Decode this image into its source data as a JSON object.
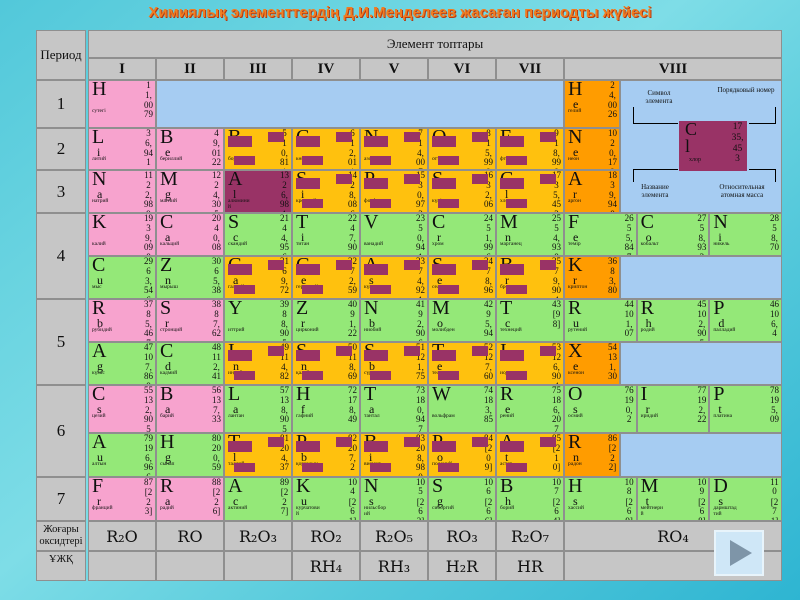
{
  "title": "Химиялық элементтердің Д.И.Менделеев жасаған периодты жүйесі",
  "colors": {
    "title": "#f07d22",
    "gray": "#c6c6c6",
    "pink": "#f7a3ce",
    "green": "#94e878",
    "gold": "#ffc10e",
    "orange": "#ff9c00",
    "plum": "#993366",
    "blue": "#a6ccf2"
  },
  "header": {
    "period_label": "Период",
    "groups_label": "Элемент топтары",
    "groups": [
      "I",
      "II",
      "III",
      "IV",
      "V",
      "VI",
      "VII",
      "VIII"
    ]
  },
  "side": {
    "periods": [
      "1",
      "2",
      "3",
      "4",
      "5",
      "6",
      "7"
    ],
    "oxides_label": "Жоғары оксидтері",
    "volatile_label": "ҰЖҚ"
  },
  "legend": {
    "symbol_label": "Символ элемента",
    "number_label": "Порядковый номер",
    "name_label": "Название элемента",
    "mass_label": "Относительная атомная масса",
    "example": {
      "sym": "Cl",
      "num": "17",
      "mass": "35,453",
      "name": "хлор"
    }
  },
  "bottom": {
    "oxides": [
      "R₂O",
      "RO",
      "R₂O₃",
      "RO₂",
      "R₂O₅",
      "RO₃",
      "R₂O₇",
      "RO₄"
    ],
    "hydrides": [
      "",
      "",
      "",
      "RH₄",
      "RH₃",
      "H₂R",
      "HR",
      ""
    ]
  },
  "nav": {
    "play_icon": "play-triangle"
  },
  "rows": [
    {
      "id": "p1",
      "cells": [
        {
          "w": "g",
          "t": "pink",
          "sym": "H",
          "num": "1",
          "mass": "1,0079",
          "name": "сутегі"
        },
        {
          "w": "g6",
          "t": "blue"
        },
        {
          "w": "noble",
          "t": "orange",
          "sym": "He",
          "num": "2",
          "mass": "4,0026",
          "name": "гелий"
        }
      ]
    },
    {
      "id": "p2",
      "cells": [
        {
          "w": "g",
          "t": "pink",
          "sym": "Li",
          "num": "3",
          "mass": "6,941",
          "name": "литий"
        },
        {
          "w": "g",
          "t": "pink",
          "sym": "Be",
          "num": "4",
          "mass": "9,0122",
          "name": "бериллий"
        },
        {
          "w": "g",
          "t": "gold",
          "sym": "B",
          "num": "5",
          "mass": "10,811",
          "name": "бор"
        },
        {
          "w": "g",
          "t": "gold",
          "sym": "C",
          "num": "6",
          "mass": "12,011",
          "name": "көміртек"
        },
        {
          "w": "g",
          "t": "gold",
          "sym": "N",
          "num": "7",
          "mass": "14,007",
          "name": "азот"
        },
        {
          "w": "g",
          "t": "gold",
          "sym": "O",
          "num": "8",
          "mass": "15,999",
          "name": "оттек"
        },
        {
          "w": "g",
          "t": "gold",
          "sym": "F",
          "num": "9",
          "mass": "18,998",
          "name": "фтор"
        },
        {
          "w": "noble",
          "t": "orange",
          "sym": "Ne",
          "num": "10",
          "mass": "20,179",
          "name": "неон"
        }
      ]
    },
    {
      "id": "p3",
      "cells": [
        {
          "w": "g",
          "t": "pink",
          "sym": "Na",
          "num": "11",
          "mass": "22,989",
          "name": "натрий"
        },
        {
          "w": "g",
          "t": "pink",
          "sym": "Mg",
          "num": "12",
          "mass": "24,305",
          "name": "магний"
        },
        {
          "w": "g",
          "t": "plum",
          "sym": "Al",
          "num": "13",
          "mass": "26,981",
          "name": "алюминий"
        },
        {
          "w": "g",
          "t": "gold",
          "sym": "Si",
          "num": "14",
          "mass": "28,086",
          "name": "кремний"
        },
        {
          "w": "g",
          "t": "gold",
          "sym": "P",
          "num": "15",
          "mass": "30,973",
          "name": "фосфор"
        },
        {
          "w": "g",
          "t": "gold",
          "sym": "S",
          "num": "16",
          "mass": "32,06",
          "name": "күкірт"
        },
        {
          "w": "g",
          "t": "gold",
          "sym": "Cl",
          "num": "17",
          "mass": "35,453",
          "name": "хлор"
        },
        {
          "w": "noble",
          "t": "orange",
          "sym": "Ar",
          "num": "18",
          "mass": "39,948",
          "name": "аргон"
        }
      ]
    },
    {
      "id": "p4a",
      "cells": [
        {
          "w": "g",
          "t": "pink",
          "sym": "K",
          "num": "19",
          "mass": "39,098",
          "name": "калий"
        },
        {
          "w": "g",
          "t": "pink",
          "sym": "Ca",
          "num": "20",
          "mass": "40,08",
          "name": "кальций"
        },
        {
          "w": "g",
          "t": "green",
          "sym": "Sc",
          "num": "21",
          "mass": "44,956",
          "name": "скандий"
        },
        {
          "w": "g",
          "t": "green",
          "sym": "Ti",
          "num": "22",
          "mass": "47,90",
          "name": "титан"
        },
        {
          "w": "g",
          "t": "green",
          "sym": "V",
          "num": "23",
          "mass": "50,941",
          "name": "ванадий"
        },
        {
          "w": "g",
          "t": "green",
          "sym": "Cr",
          "num": "24",
          "mass": "51,996",
          "name": "хром"
        },
        {
          "w": "g",
          "t": "green",
          "sym": "Mn",
          "num": "25",
          "mass": "54,938",
          "name": "марганец"
        },
        {
          "w": "t",
          "t": "green",
          "sym": "Fe",
          "num": "26",
          "mass": "55,847",
          "name": "темір"
        },
        {
          "w": "t",
          "t": "green",
          "sym": "Co",
          "num": "27",
          "mass": "58,933",
          "name": "кобальт"
        },
        {
          "w": "t",
          "t": "green",
          "sym": "Ni",
          "num": "28",
          "mass": "58,70",
          "name": "никель"
        }
      ]
    },
    {
      "id": "p4b",
      "cells": [
        {
          "w": "g",
          "t": "green",
          "sym": "Cu",
          "num": "29",
          "mass": "63,546",
          "name": "мыс"
        },
        {
          "w": "g",
          "t": "green",
          "sym": "Zn",
          "num": "30",
          "mass": "65,38",
          "name": "мырыш"
        },
        {
          "w": "g",
          "t": "gold",
          "sym": "Ga",
          "num": "31",
          "mass": "69,72",
          "name": "галлий"
        },
        {
          "w": "g",
          "t": "gold",
          "sym": "Ge",
          "num": "32",
          "mass": "72,59",
          "name": "германий"
        },
        {
          "w": "g",
          "t": "gold",
          "sym": "As",
          "num": "33",
          "mass": "74,921",
          "name": "күшән"
        },
        {
          "w": "g",
          "t": "gold",
          "sym": "Se",
          "num": "34",
          "mass": "78,96",
          "name": "селен"
        },
        {
          "w": "g",
          "t": "gold",
          "sym": "Br",
          "num": "35",
          "mass": "79,904",
          "name": "бром"
        },
        {
          "w": "noble",
          "t": "orange",
          "sym": "Kr",
          "num": "36",
          "mass": "83,80",
          "name": "криптон"
        },
        {
          "w": "nr",
          "t": "blue"
        }
      ]
    },
    {
      "id": "p5a",
      "cells": [
        {
          "w": "g",
          "t": "pink",
          "sym": "Rb",
          "num": "37",
          "mass": "85,467",
          "name": "рубидий"
        },
        {
          "w": "g",
          "t": "pink",
          "sym": "Sr",
          "num": "38",
          "mass": "87,62",
          "name": "стронций"
        },
        {
          "w": "g",
          "t": "green",
          "sym": "Y",
          "num": "39",
          "mass": "88,905",
          "name": "иттрий"
        },
        {
          "w": "g",
          "t": "green",
          "sym": "Zr",
          "num": "40",
          "mass": "91,22",
          "name": "цирконий"
        },
        {
          "w": "g",
          "t": "green",
          "sym": "Nb",
          "num": "41",
          "mass": "92,906",
          "name": "ниобий"
        },
        {
          "w": "g",
          "t": "green",
          "sym": "Mo",
          "num": "42",
          "mass": "95,94",
          "name": "молибден"
        },
        {
          "w": "g",
          "t": "green",
          "sym": "Tc",
          "num": "43",
          "mass": "[98]",
          "name": "технеций"
        },
        {
          "w": "t",
          "t": "green",
          "sym": "Ru",
          "num": "44",
          "mass": "101,07",
          "name": "рутений"
        },
        {
          "w": "t",
          "t": "green",
          "sym": "Rh",
          "num": "45",
          "mass": "102,905",
          "name": "родий"
        },
        {
          "w": "t",
          "t": "green",
          "sym": "Pd",
          "num": "46",
          "mass": "106,4",
          "name": "палладий"
        }
      ]
    },
    {
      "id": "p5b",
      "cells": [
        {
          "w": "g",
          "t": "green",
          "sym": "Ag",
          "num": "47",
          "mass": "107,868",
          "name": "күміс"
        },
        {
          "w": "g",
          "t": "green",
          "sym": "Cd",
          "num": "48",
          "mass": "112,41",
          "name": "кадмий"
        },
        {
          "w": "g",
          "t": "gold",
          "sym": "In",
          "num": "49",
          "mass": "114,82",
          "name": "индий"
        },
        {
          "w": "g",
          "t": "gold",
          "sym": "Sn",
          "num": "50",
          "mass": "118,69",
          "name": "қалайы"
        },
        {
          "w": "g",
          "t": "gold",
          "sym": "Sb",
          "num": "51",
          "mass": "121,75",
          "name": "сүрме"
        },
        {
          "w": "g",
          "t": "gold",
          "sym": "Te",
          "num": "52",
          "mass": "127,60",
          "name": "теллур"
        },
        {
          "w": "g",
          "t": "gold",
          "sym": "I",
          "num": "53",
          "mass": "126,904",
          "name": "иод"
        },
        {
          "w": "noble",
          "t": "orange",
          "sym": "Xe",
          "num": "54",
          "mass": "131,30",
          "name": "ксенон"
        },
        {
          "w": "nr",
          "t": "blue"
        }
      ]
    },
    {
      "id": "p6a",
      "cells": [
        {
          "w": "g",
          "t": "pink",
          "sym": "Cs",
          "num": "55",
          "mass": "132,905",
          "name": "цезий"
        },
        {
          "w": "g",
          "t": "pink",
          "sym": "Ba",
          "num": "56",
          "mass": "137,33",
          "name": "барий"
        },
        {
          "w": "g",
          "t": "green",
          "sym": "La",
          "num": "57",
          "mass": "138,905",
          "name": "лантан"
        },
        {
          "w": "g",
          "t": "green",
          "sym": "Hf",
          "num": "72",
          "mass": "178,49",
          "name": "гафний"
        },
        {
          "w": "g",
          "t": "green",
          "sym": "Ta",
          "num": "73",
          "mass": "180,947",
          "name": "тантал"
        },
        {
          "w": "g",
          "t": "green",
          "sym": "W",
          "num": "74",
          "mass": "183,85",
          "name": "вольфрам"
        },
        {
          "w": "g",
          "t": "green",
          "sym": "Re",
          "num": "75",
          "mass": "186,207",
          "name": "рений"
        },
        {
          "w": "t",
          "t": "green",
          "sym": "Os",
          "num": "76",
          "mass": "190,2",
          "name": "осмий"
        },
        {
          "w": "t",
          "t": "green",
          "sym": "Ir",
          "num": "77",
          "mass": "192,22",
          "name": "иридий"
        },
        {
          "w": "t",
          "t": "green",
          "sym": "Pt",
          "num": "78",
          "mass": "195,09",
          "name": "платина"
        }
      ]
    },
    {
      "id": "p6b",
      "cells": [
        {
          "w": "g",
          "t": "green",
          "sym": "Au",
          "num": "79",
          "mass": "196,966",
          "name": "алтын"
        },
        {
          "w": "g",
          "t": "green",
          "sym": "Hg",
          "num": "80",
          "mass": "200,59",
          "name": "сынап"
        },
        {
          "w": "g",
          "t": "gold",
          "sym": "Tl",
          "num": "81",
          "mass": "204,37",
          "name": "таллий"
        },
        {
          "w": "g",
          "t": "gold",
          "sym": "Pb",
          "num": "82",
          "mass": "207,2",
          "name": "қорғасын"
        },
        {
          "w": "g",
          "t": "gold",
          "sym": "Bi",
          "num": "83",
          "mass": "208,980",
          "name": "висмут"
        },
        {
          "w": "g",
          "t": "gold",
          "sym": "Po",
          "num": "84",
          "mass": "[209]",
          "name": "полоний"
        },
        {
          "w": "g",
          "t": "gold",
          "sym": "At",
          "num": "85",
          "mass": "[210]",
          "name": "астат"
        },
        {
          "w": "noble",
          "t": "orange",
          "sym": "Rn",
          "num": "86",
          "mass": "[222]",
          "name": "радон"
        },
        {
          "w": "nr",
          "t": "blue"
        }
      ]
    },
    {
      "id": "p7",
      "cells": [
        {
          "w": "g",
          "t": "pink",
          "sym": "Fr",
          "num": "87",
          "mass": "[223]",
          "name": "франций"
        },
        {
          "w": "g",
          "t": "pink",
          "sym": "Ra",
          "num": "88",
          "mass": "[226]",
          "name": "радий"
        },
        {
          "w": "g",
          "t": "green",
          "sym": "Ac",
          "num": "89",
          "mass": "[227]",
          "name": "актиний"
        },
        {
          "w": "g",
          "t": "green",
          "sym": "Ku",
          "num": "104",
          "mass": "[261]",
          "name": "курчатовий"
        },
        {
          "w": "g",
          "t": "green",
          "sym": "Ns",
          "num": "105",
          "mass": "[262]",
          "name": "нильсборий"
        },
        {
          "w": "g",
          "t": "green",
          "sym": "Sg",
          "num": "106",
          "mass": "[266]",
          "name": "сиборгий"
        },
        {
          "w": "g",
          "t": "green",
          "sym": "Bh",
          "num": "107",
          "mass": "[264]",
          "name": "борий"
        },
        {
          "w": "t",
          "t": "green",
          "sym": "Hs",
          "num": "108",
          "mass": "[269]",
          "name": "хассий"
        },
        {
          "w": "t",
          "t": "green",
          "sym": "Mt",
          "num": "109",
          "mass": "[268]",
          "name": "мейтнерий"
        },
        {
          "w": "t",
          "t": "green",
          "sym": "Ds",
          "num": "110",
          "mass": "[271]",
          "name": "дармштадтий"
        }
      ]
    }
  ]
}
